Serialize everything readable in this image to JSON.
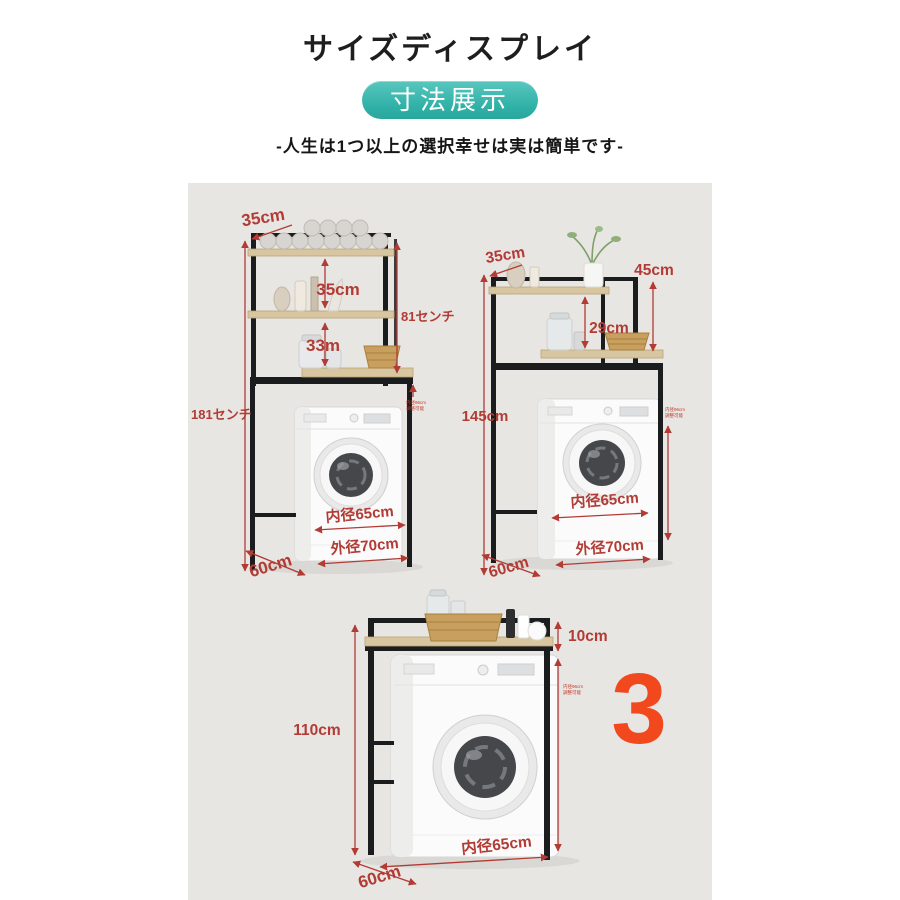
{
  "header": {
    "title": "サイズディスプレイ",
    "badge": "寸法展示",
    "subtitle": "-人生は1つ以上の選択幸せは実は簡単です-"
  },
  "colors": {
    "badge_teal": "#2fb0a6",
    "dimension_red": "#b23b35",
    "accent_red": "#f2481d",
    "photo_background": "#e7e6e3",
    "wood": "#d8c6a0",
    "frame_black": "#1b1c1e"
  },
  "tiny_note": {
    "line1": "内径96cm",
    "line2": "調整可能"
  },
  "diagrams": {
    "d1": {
      "top_width": "35cm",
      "gap1": "35cm",
      "gap2": "33m",
      "right_height": "81センチ",
      "total_height": "181センチ",
      "inner_width": "内径65cm",
      "outer_width": "外径70cm",
      "depth": "60cm"
    },
    "d2": {
      "top_width": "35cm",
      "upper_right": "45cm",
      "gap": "29cm",
      "total_height": "145cm",
      "inner_width": "内径65cm",
      "outer_width": "外径70cm",
      "depth": "60cm"
    },
    "d3": {
      "clearance": "10cm",
      "total_height": "110cm",
      "inner_width": "内径65cm",
      "depth": "60cm",
      "big_number": "3"
    }
  }
}
